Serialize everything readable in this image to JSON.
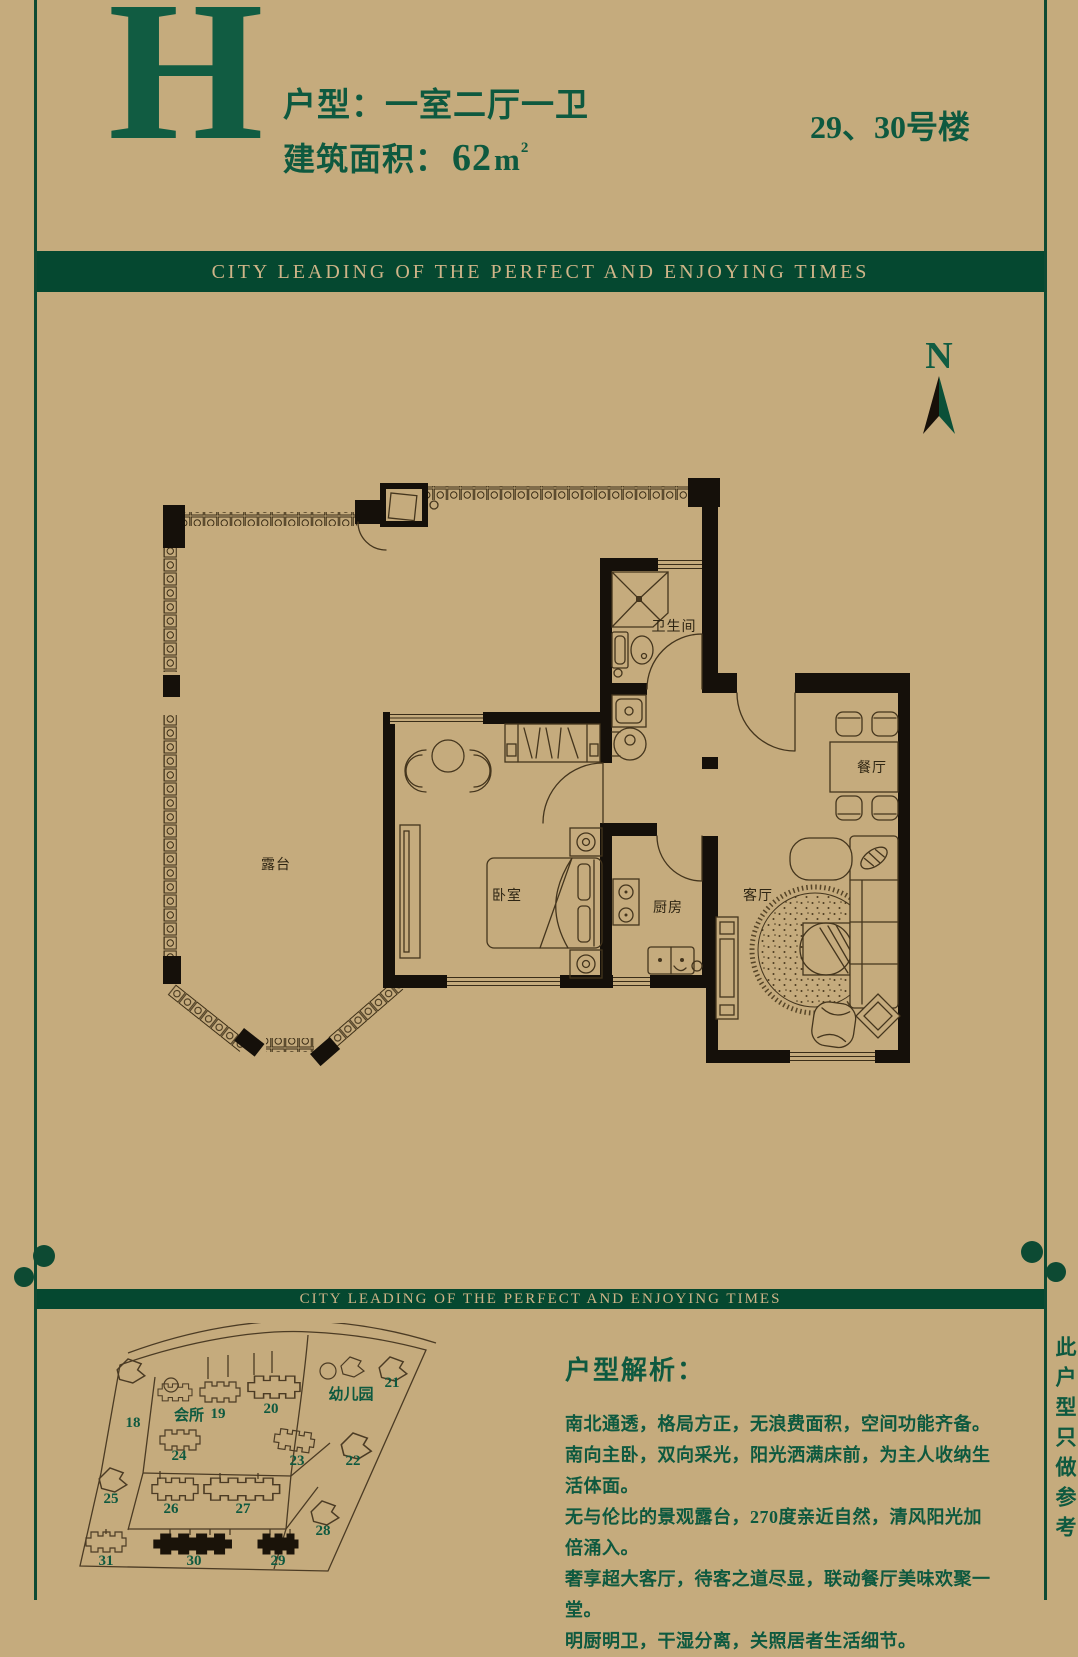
{
  "header": {
    "plan_letter": "H",
    "unit_label": "户型：一室二厅一卫",
    "area_label": "建筑面积：",
    "area_value": "62",
    "area_unit": "m",
    "area_sup": "2",
    "building_no": "29、30号楼"
  },
  "banner": {
    "text": "CITY LEADING OF THE PERFECT AND ENJOYING TIMES"
  },
  "compass": {
    "label": "N"
  },
  "floorplan": {
    "rooms": {
      "terrace": "露台",
      "bedroom": "卧室",
      "bathroom": "卫生间",
      "kitchen": "厨房",
      "living": "客厅",
      "dining": "餐厅"
    }
  },
  "sitemap": {
    "labels": [
      {
        "text": "18"
      },
      {
        "text": "会所"
      },
      {
        "text": "19"
      },
      {
        "text": "20"
      },
      {
        "text": "幼儿园"
      },
      {
        "text": "21"
      },
      {
        "text": "24"
      },
      {
        "text": "23"
      },
      {
        "text": "22"
      },
      {
        "text": "25"
      },
      {
        "text": "26"
      },
      {
        "text": "27"
      },
      {
        "text": "28"
      },
      {
        "text": "31"
      },
      {
        "text": "30"
      },
      {
        "text": "29"
      }
    ],
    "highlighted": [
      "29",
      "30"
    ]
  },
  "analysis": {
    "title": "户型解析：",
    "lines": [
      "南北通透，格局方正，无浪费面积，空间功能齐备。",
      "南向主卧，双向采光，阳光洒满床前，为主人收纳生活体面。",
      "无与伦比的景观露台，270度亲近自然，清风阳光加倍涌入。",
      "奢享超大客厅，待客之道尽显，联动餐厅美味欢聚一堂。",
      "明厨明卫，干湿分离，关照居者生活细节。"
    ]
  },
  "side_note": "此户型只做参考",
  "colors": {
    "background": "#c5ab7d",
    "accent_green": "#0e593f",
    "banner_green": "#054830",
    "banner_text": "#cfb488",
    "wall_black": "#15100a"
  }
}
